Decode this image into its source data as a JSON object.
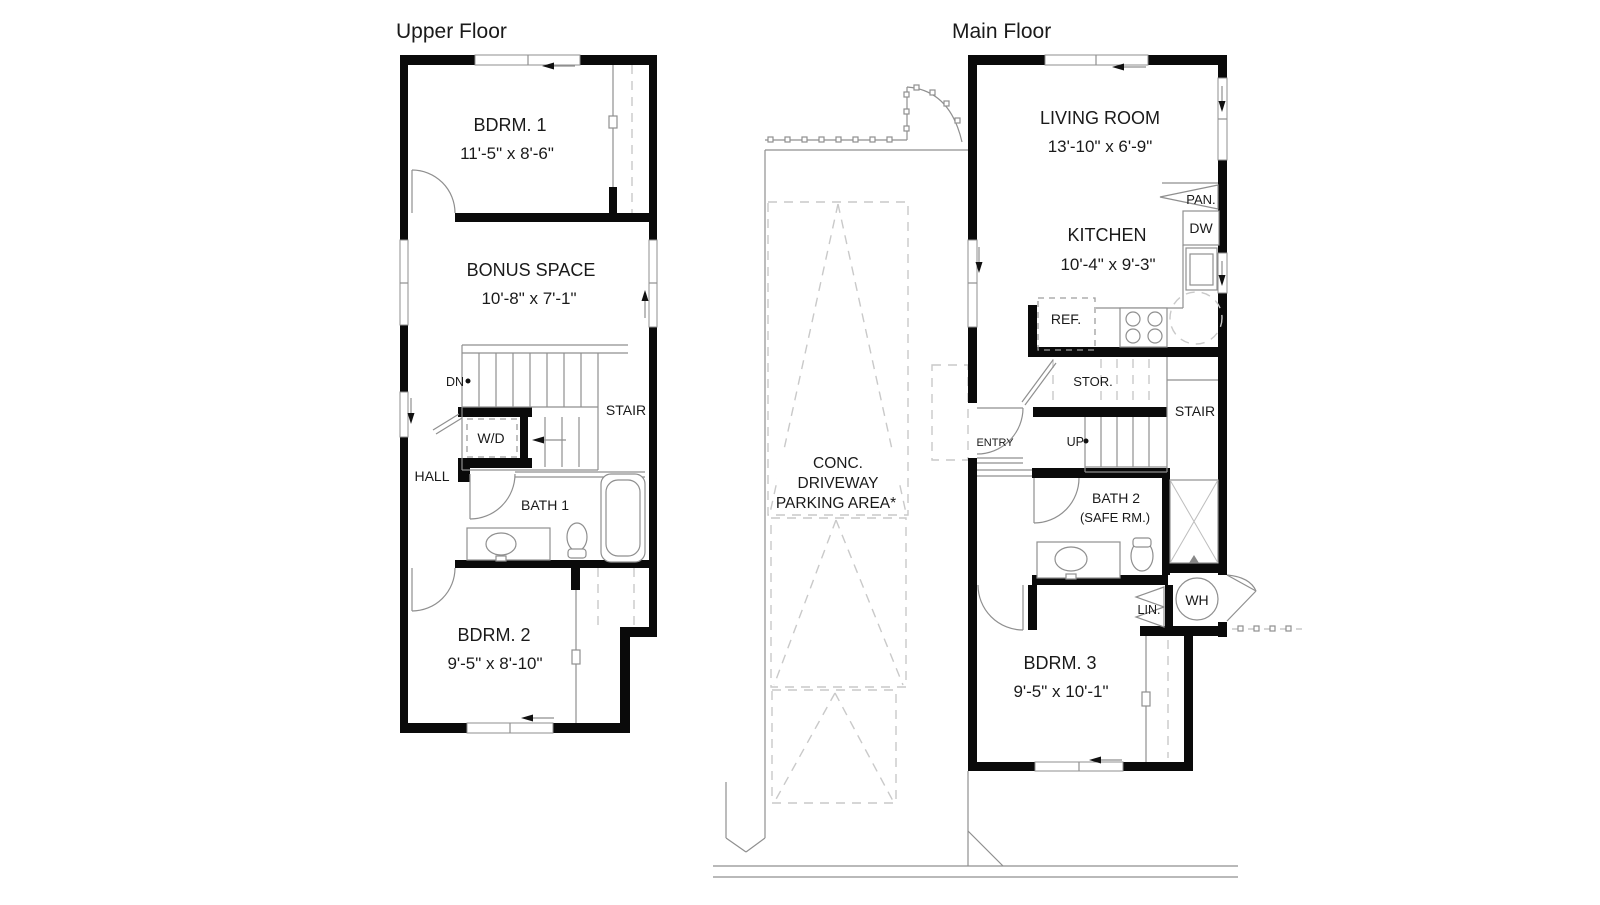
{
  "upper_floor": {
    "title": "Upper Floor",
    "rooms": [
      {
        "name": "BDRM. 1",
        "dims": "11'-5\" x 8'-6\""
      },
      {
        "name": "BONUS SPACE",
        "dims": "10'-8\" x 7'-1\""
      },
      {
        "name": "BDRM. 2",
        "dims": "9'-5\" x 8'-10\""
      }
    ],
    "labels": {
      "down": "DN",
      "stair": "STAIR",
      "washer_dryer": "W/D",
      "hall": "HALL",
      "bath": "BATH 1"
    }
  },
  "main_floor": {
    "title": "Main Floor",
    "rooms": [
      {
        "name": "LIVING ROOM",
        "dims": "13'-10\" x 6'-9\""
      },
      {
        "name": "KITCHEN",
        "dims": "10'-4\" x 9'-3\""
      },
      {
        "name": "BDRM. 3",
        "dims": "9'-5\" x 10'-1\""
      }
    ],
    "labels": {
      "pantry": "PAN.",
      "dishwasher": "DW",
      "refrigerator": "REF.",
      "storage": "STOR.",
      "stair": "STAIR",
      "up": "UP",
      "entry": "ENTRY",
      "bath": "BATH 2",
      "bath_sub": "(SAFE RM.)",
      "linen": "LIN.",
      "water_heater": "WH"
    }
  },
  "site": {
    "driveway_lines": [
      "CONC.",
      "DRIVEWAY",
      "PARKING AREA*"
    ]
  },
  "colors": {
    "wall": "#0a0a0a",
    "line": "#8f8f8f",
    "dash": "#c9c9c9",
    "text": "#1a1a1a"
  }
}
